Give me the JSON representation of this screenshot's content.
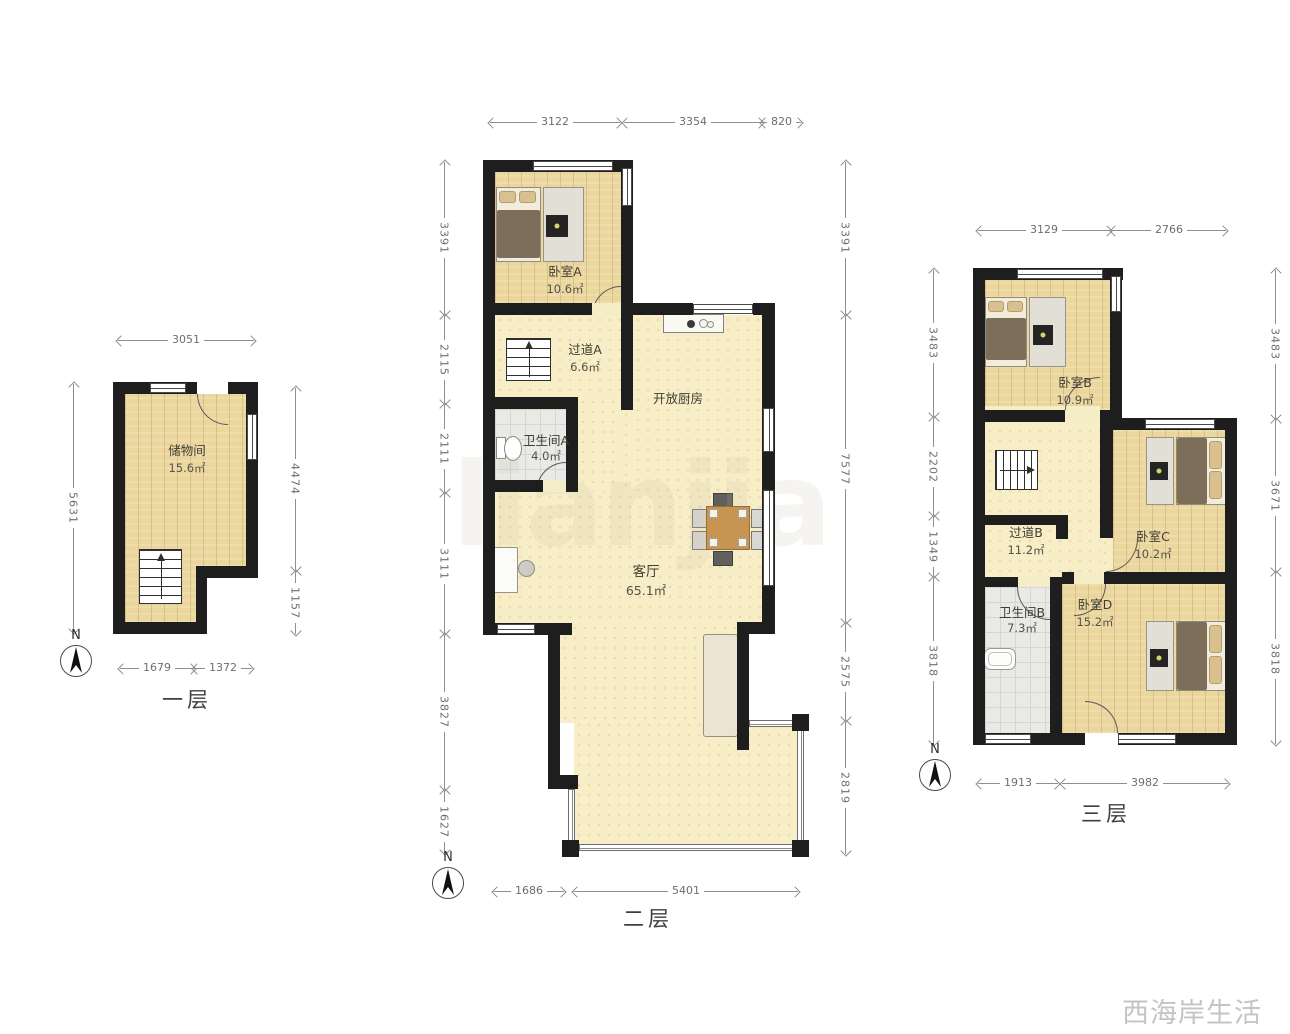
{
  "compass": {
    "label": "N"
  },
  "watermark": "西海岸生活",
  "bg_watermark": "lianjia",
  "floor1": {
    "name": "一层",
    "rooms": {
      "storage": {
        "label": "储物间",
        "area": "15.6㎡"
      }
    },
    "dims": {
      "top": [
        "3051"
      ],
      "left": [
        "5631"
      ],
      "right": [
        "4474",
        "1157"
      ],
      "bottom": [
        "1679",
        "1372"
      ]
    }
  },
  "floor2": {
    "name": "二层",
    "rooms": {
      "bedroomA": {
        "label": "卧室A",
        "area": "10.6㎡"
      },
      "hallwayA": {
        "label": "过道A",
        "area": "6.6㎡"
      },
      "bathroomA": {
        "label": "卫生间A",
        "area": "4.0㎡"
      },
      "kitchen": {
        "label": "开放厨房"
      },
      "living": {
        "label": "客厅",
        "area": "65.1㎡"
      }
    },
    "dims": {
      "top": [
        "3122",
        "3354",
        "820"
      ],
      "left": [
        "3391",
        "2115",
        "2111",
        "3111",
        "3827",
        "1627"
      ],
      "right": [
        "3391",
        "7577",
        "2575",
        "2819"
      ],
      "bottom": [
        "1686",
        "5401"
      ]
    }
  },
  "floor3": {
    "name": "三层",
    "rooms": {
      "bedroomB": {
        "label": "卧室B",
        "area": "10.9㎡"
      },
      "hallwayB": {
        "label": "过道B",
        "area": "11.2㎡"
      },
      "bedroomC": {
        "label": "卧室C",
        "area": "10.2㎡"
      },
      "bathroomB": {
        "label": "卫生间B",
        "area": "7.3㎡"
      },
      "bedroomD": {
        "label": "卧室D",
        "area": "15.2㎡"
      }
    },
    "dims": {
      "top": [
        "3129",
        "2766"
      ],
      "left": [
        "3483",
        "2202",
        "1349",
        "3818"
      ],
      "right": [
        "3483",
        "3671",
        "3818"
      ],
      "bottom": [
        "1913",
        "3982"
      ]
    }
  }
}
